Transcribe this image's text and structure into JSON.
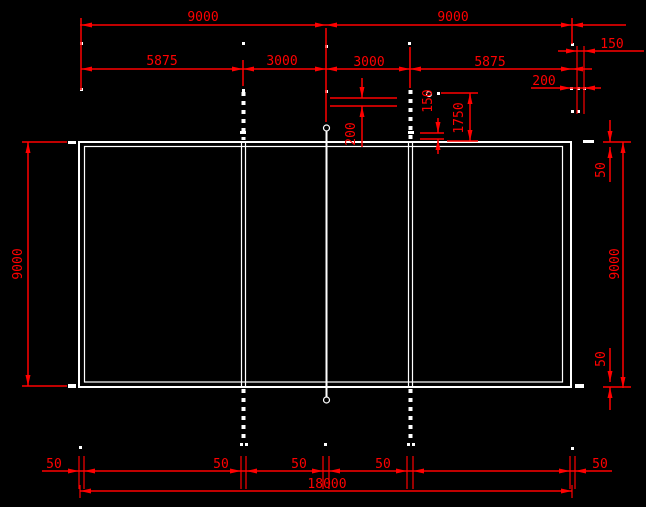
{
  "drawing": {
    "type": "cad-court-plan",
    "colors": {
      "background": "#000000",
      "court_lines": "#ffffff",
      "dimension_lines": "#ff0000"
    },
    "dimensions": {
      "top_half_left": "9000",
      "top_half_right": "9000",
      "top_right_offset_150": "150",
      "row2_left_5875": "5875",
      "row2_left_3000": "3000",
      "row2_right_3000": "3000",
      "row2_right_5875": "5875",
      "top_right_offset_200": "200",
      "mid_net_200": "200",
      "mid_net_150": "150",
      "mid_1750": "1750",
      "left_side_9000": "9000",
      "right_side_50_top": "50",
      "right_side_9000": "9000",
      "right_side_50_bottom": "50",
      "bottom_50_left_edge": "50",
      "bottom_50_attack_left": "50",
      "bottom_50_center": "50",
      "bottom_50_attack_right": "50",
      "bottom_50_right_edge": "50",
      "bottom_total_18000": "18000"
    }
  }
}
